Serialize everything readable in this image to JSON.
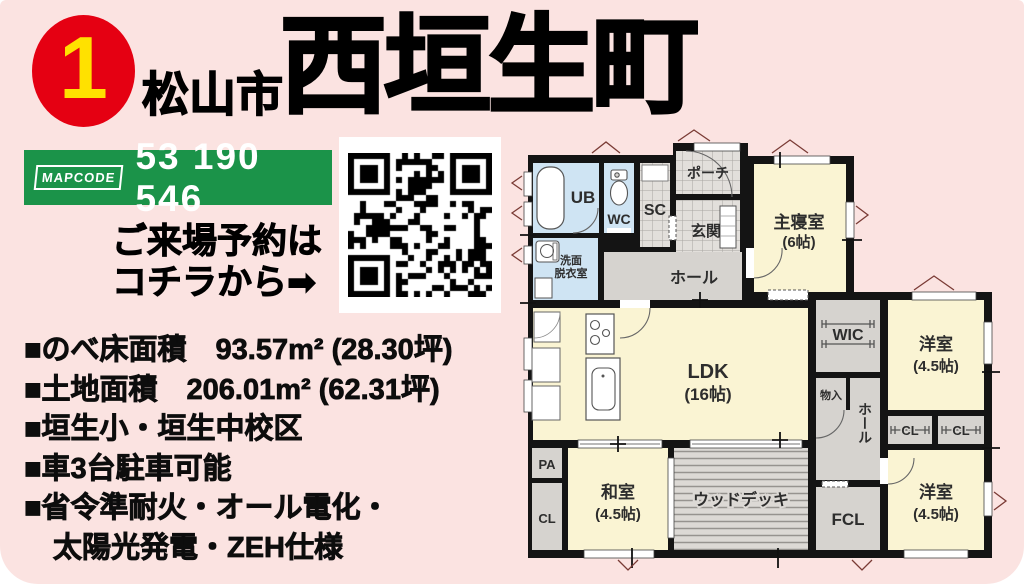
{
  "header": {
    "badge": "1",
    "city": "松山市",
    "town": "西垣生町"
  },
  "mapcode": {
    "logo": "MAPCODE",
    "value": "53 190 546"
  },
  "reservation": {
    "line1": "ご来場予約は",
    "line2": "コチラから➡"
  },
  "details": [
    "■のべ床面積　93.57m² (28.30坪)",
    "■土地面積　206.01m² (62.31坪)",
    "■垣生小・垣生中校区",
    "■車3台駐車可能",
    "■省令準耐火・オール電化・",
    "　太陽光発電・ZEH仕様"
  ],
  "plan": {
    "ub": "UB",
    "wc": "WC",
    "sc": "SC",
    "porch": "ポーチ",
    "genkan": "玄関",
    "senmen1": "洗面",
    "senmen2": "脱衣室",
    "hall": "ホール",
    "master_name": "主寝室",
    "master_size": "(6帖)",
    "wic": "WIC",
    "western1_name": "洋室",
    "western1_size": "(4.5帖)",
    "monoire": "物入",
    "hall2": "ホール",
    "cl1": "CL",
    "cl2": "CL",
    "ldk_name": "LDK",
    "ldk_size": "(16帖)",
    "pa": "PA",
    "cl3": "CL",
    "washitsu_name": "和室",
    "washitsu_size": "(4.5帖)",
    "deck": "ウッドデッキ",
    "fcl": "FCL",
    "western2_name": "洋室",
    "western2_size": "(4.5帖)"
  },
  "colors": {
    "background": "#fbe3e1",
    "accent_red": "#e50012",
    "badge_number_yellow": "#ffe100",
    "mapcode_green": "#1b9349",
    "room_cream": "#faf4d3",
    "room_blue": "#cfe4f3",
    "room_gray": "#d6d3cf",
    "wall_black": "#141414"
  }
}
